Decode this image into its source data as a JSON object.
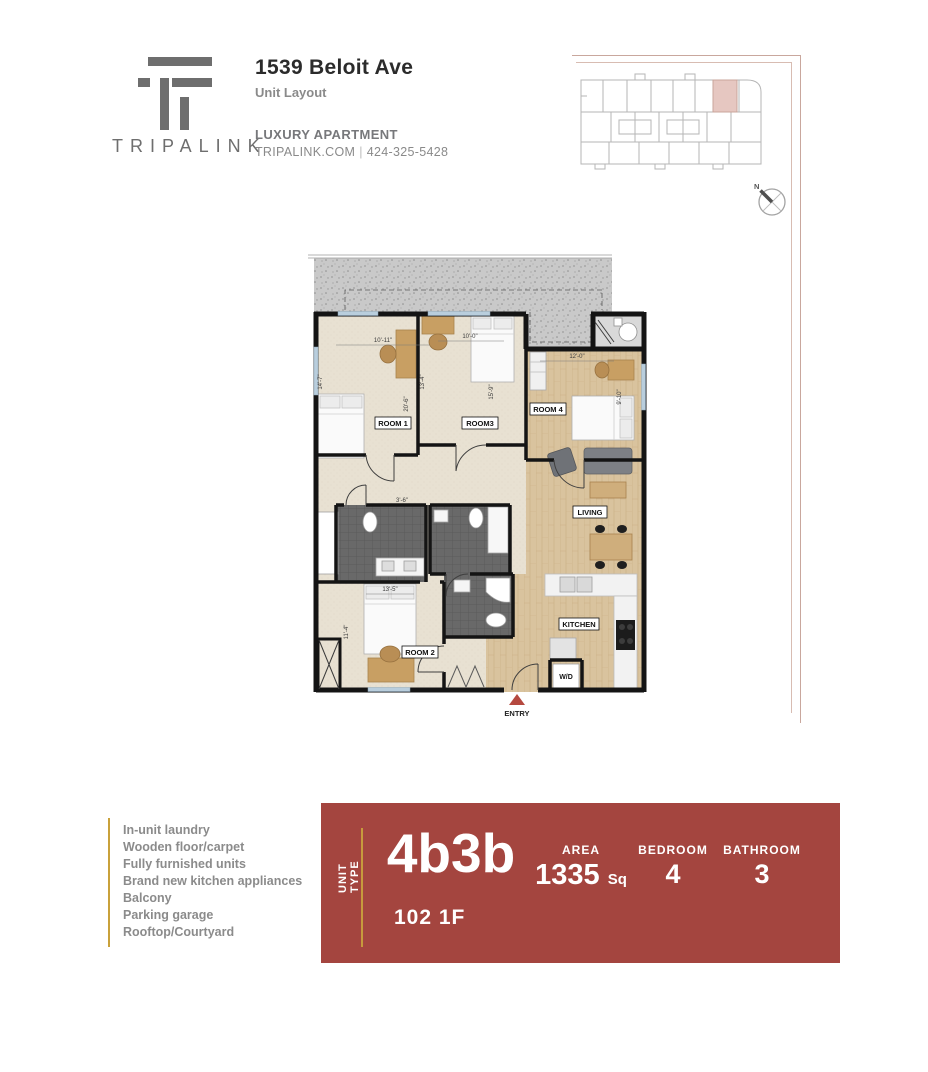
{
  "header": {
    "brand": "TRIPALINK",
    "title": "1539 Beloit Ave",
    "subtitle": "Unit Layout",
    "tagline": "LUXURY APARTMENT",
    "website": "TRIPALINK.COM",
    "separator": "|",
    "phone": "424-325-5428"
  },
  "keyplan": {
    "north_label": "N"
  },
  "floorplan": {
    "labels": {
      "room1": "ROOM 1",
      "room3": "ROOM3",
      "room4": "ROOM 4",
      "living": "LIVING",
      "kitchen": "KITCHEN",
      "room2": "ROOM 2",
      "wd": "W/D",
      "entry": "ENTRY"
    },
    "dims": {
      "room1_w": "10'-11\"",
      "room1_h": "14'-7\"",
      "room1_d": "20'-6\"",
      "room3_l": "13'-4\"",
      "room3_w": "10'-0\"",
      "room3_h": "15'-9\"",
      "room4_w": "12'-0\"",
      "room4_h": "9'-10\"",
      "hall": "3'-6\"",
      "room2_w": "13'-5\"",
      "room2_h": "11'-4\""
    }
  },
  "features": {
    "items": [
      "In-unit laundry",
      "Wooden floor/carpet",
      "Fully furnished units",
      "Brand new kitchen appliances",
      "Balcony",
      "Parking garage",
      "Rooftop/Courtyard"
    ]
  },
  "banner": {
    "unit_type_label": "UNIT TYPE",
    "unit_type": "4b3b",
    "area_label": "AREA",
    "area_value": "1335",
    "area_unit": "Sq",
    "bedroom_label": "BEDROOM",
    "bedroom_value": "4",
    "bathroom_label": "BATHROOM",
    "bathroom_value": "3",
    "unit_number": "102 1F"
  },
  "colors": {
    "banner_red": "#a4453f",
    "gold": "#c79a3d",
    "logo_gray": "#6e6e6e",
    "text_gray": "#8b8b8b",
    "highlight_pink": "#e6c7c1"
  }
}
